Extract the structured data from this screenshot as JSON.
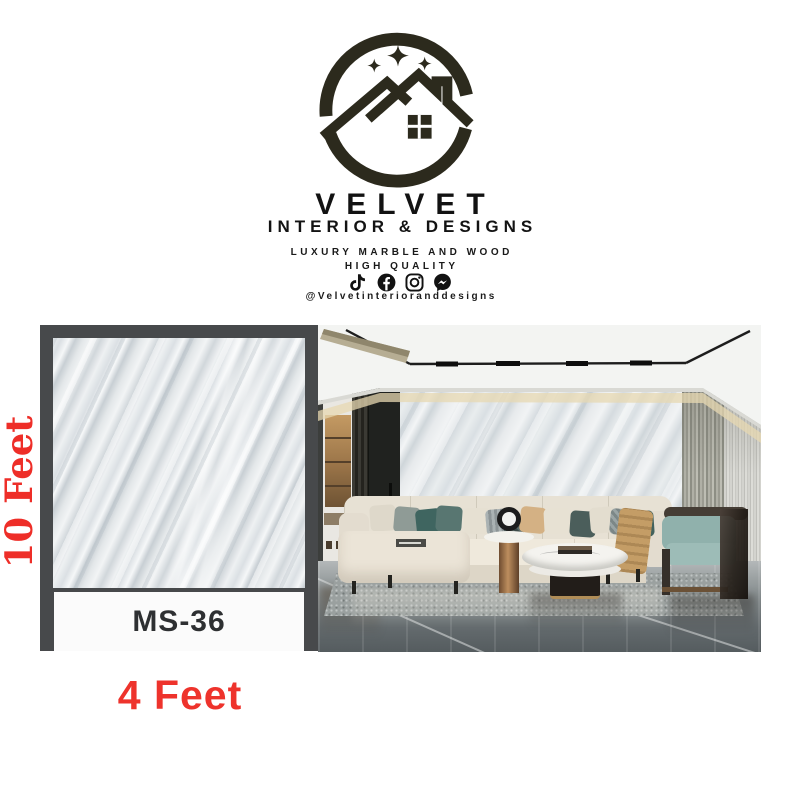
{
  "brand": {
    "name": "VELVET",
    "tagline": "INTERIOR & DESIGNS",
    "line1": "LUXURY MARBLE AND WOOD",
    "line2": "HIGH QUALITY",
    "handle": "@Velvetinterioranddesigns"
  },
  "social_icons": [
    "tiktok-icon",
    "facebook-icon",
    "instagram-icon",
    "messenger-icon"
  ],
  "product": {
    "code": "MS-36",
    "height": "10 Feet",
    "width": "4 Feet"
  },
  "colors": {
    "accent_red": "#ee332c",
    "logo_ink": "#2c2a1d",
    "frame_gray": "#47494b",
    "marble_base": "#dfe3e6",
    "label_text": "#2e3032"
  }
}
